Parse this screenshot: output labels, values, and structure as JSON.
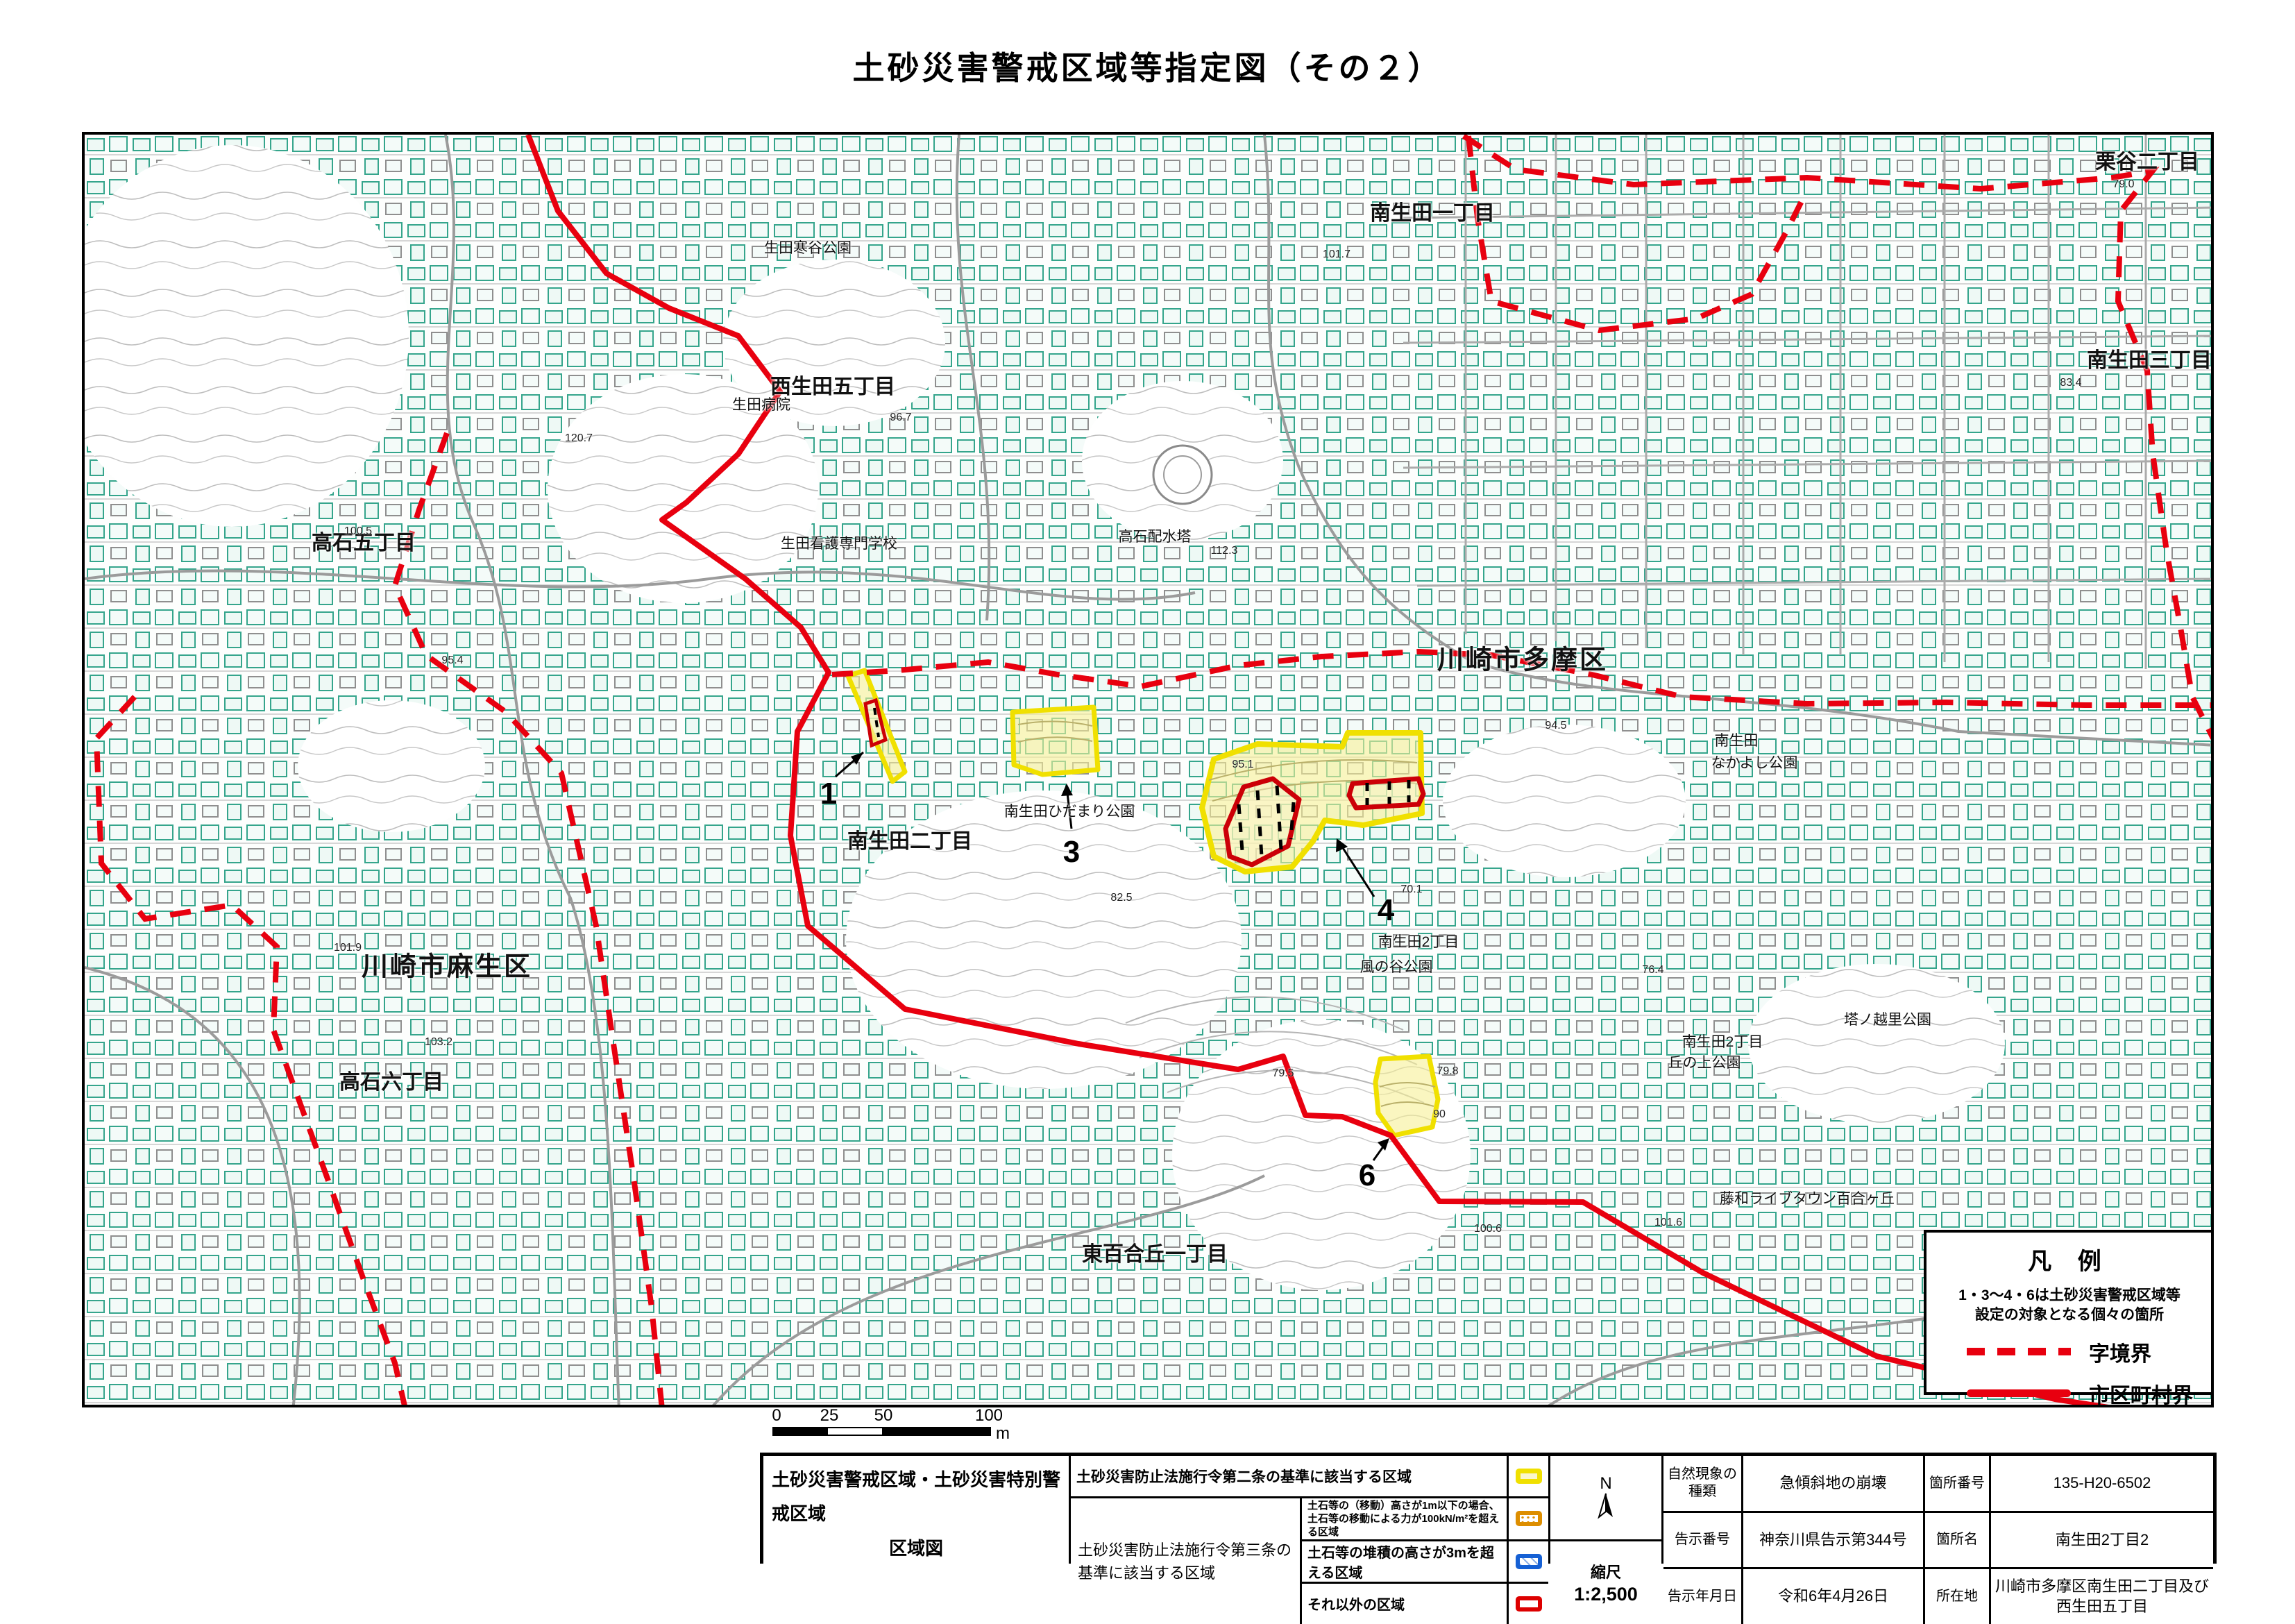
{
  "page": {
    "title": "土砂災害警戒区域等指定図（その２）"
  },
  "map": {
    "region_labels": [
      {
        "text": "南生田一丁目"
      },
      {
        "text": "栗谷二丁目"
      },
      {
        "text": "南生田三丁目"
      },
      {
        "text": "西生田五丁目"
      },
      {
        "text": "高石五丁目"
      },
      {
        "text": "川崎市多摩区"
      },
      {
        "text": "南生田二丁目"
      },
      {
        "text": "川崎市麻生区"
      },
      {
        "text": "高石六丁目"
      },
      {
        "text": "東百合丘一丁目"
      }
    ],
    "facility_labels": [
      {
        "text": "生田寒谷公園"
      },
      {
        "text": "生田病院"
      },
      {
        "text": "生田看護専門学校"
      },
      {
        "text": "高石配水塔"
      },
      {
        "text": "南生田"
      },
      {
        "text": "なかよし公園"
      },
      {
        "text": "南生田ひだまり公園"
      },
      {
        "text": "南生田2丁目"
      },
      {
        "text": "風の谷公園"
      },
      {
        "text": "南生田2丁目"
      },
      {
        "text": "丘の上公園"
      },
      {
        "text": "塔ノ越里公園"
      },
      {
        "text": "藤和ライブタウン百合ヶ丘"
      }
    ],
    "site_markers": [
      {
        "num": "1"
      },
      {
        "num": "3"
      },
      {
        "num": "4"
      },
      {
        "num": "6"
      }
    ],
    "elevations": [
      {
        "v": "101.7"
      },
      {
        "v": "79.0"
      },
      {
        "v": "83.4"
      },
      {
        "v": "96.7"
      },
      {
        "v": "100.5"
      },
      {
        "v": "95.4"
      },
      {
        "v": "112.3"
      },
      {
        "v": "101.9"
      },
      {
        "v": "103.2"
      },
      {
        "v": "95.1"
      },
      {
        "v": "94.5"
      },
      {
        "v": "70.1"
      },
      {
        "v": "82.5"
      },
      {
        "v": "79.5"
      },
      {
        "v": "79.8"
      },
      {
        "v": "90"
      },
      {
        "v": "100.6"
      },
      {
        "v": "76.4"
      },
      {
        "v": "101.6"
      },
      {
        "v": "120.7"
      }
    ],
    "legend": {
      "title": "凡 例",
      "note_line1": "1・3～4・6は土砂災害警戒区域等",
      "note_line2": "設定の対象となる個々の箇所",
      "dashed_label": "字境界",
      "solid_label": "市区町村界"
    },
    "scalebar": {
      "ticks": [
        "0",
        "25",
        "50",
        "100"
      ],
      "unit": "m"
    }
  },
  "table": {
    "map_title_line1": "土砂災害警戒区域・土砂災害特別警戒区域",
    "map_title_line2": "区域図",
    "row1_label": "土砂災害防止法施行令第二条の基準に該当する区域",
    "article3_label": "土砂災害防止法施行令第三条の基準に該当する区域",
    "row2_desc_line1": "土石等の（移動）高さが1m以下の場合、",
    "row2_desc_line2": "土石等の移動による力が100kN/m²を超える区域",
    "row3_desc": "土石等の堆積の高さが3mを超える区域",
    "row4_desc": "それ以外の区域",
    "compass_label": "N",
    "scale_label": "縮尺",
    "scale_value": "1:2,500",
    "info": {
      "nature_label": "自然現象の種類",
      "nature_value": "急傾斜地の崩壊",
      "notice_no_label": "告示番号",
      "notice_no_value": "神奈川県告示第344号",
      "notice_date_label": "告示年月日",
      "notice_date_value": "令和6年4月26日",
      "site_no_label": "箇所番号",
      "site_no_value": "135-H20-6502",
      "site_name_label": "箇所名",
      "site_name_value": "南生田2丁目2",
      "location_label": "所在地",
      "location_value": "川崎市多摩区南生田二丁目及び西生田五丁目"
    }
  },
  "colors": {
    "boundary_red": "#e8000f",
    "hazard_yellow": "#f0e000",
    "special_red": "#cc0007",
    "building_teal": "#2fa08a"
  }
}
